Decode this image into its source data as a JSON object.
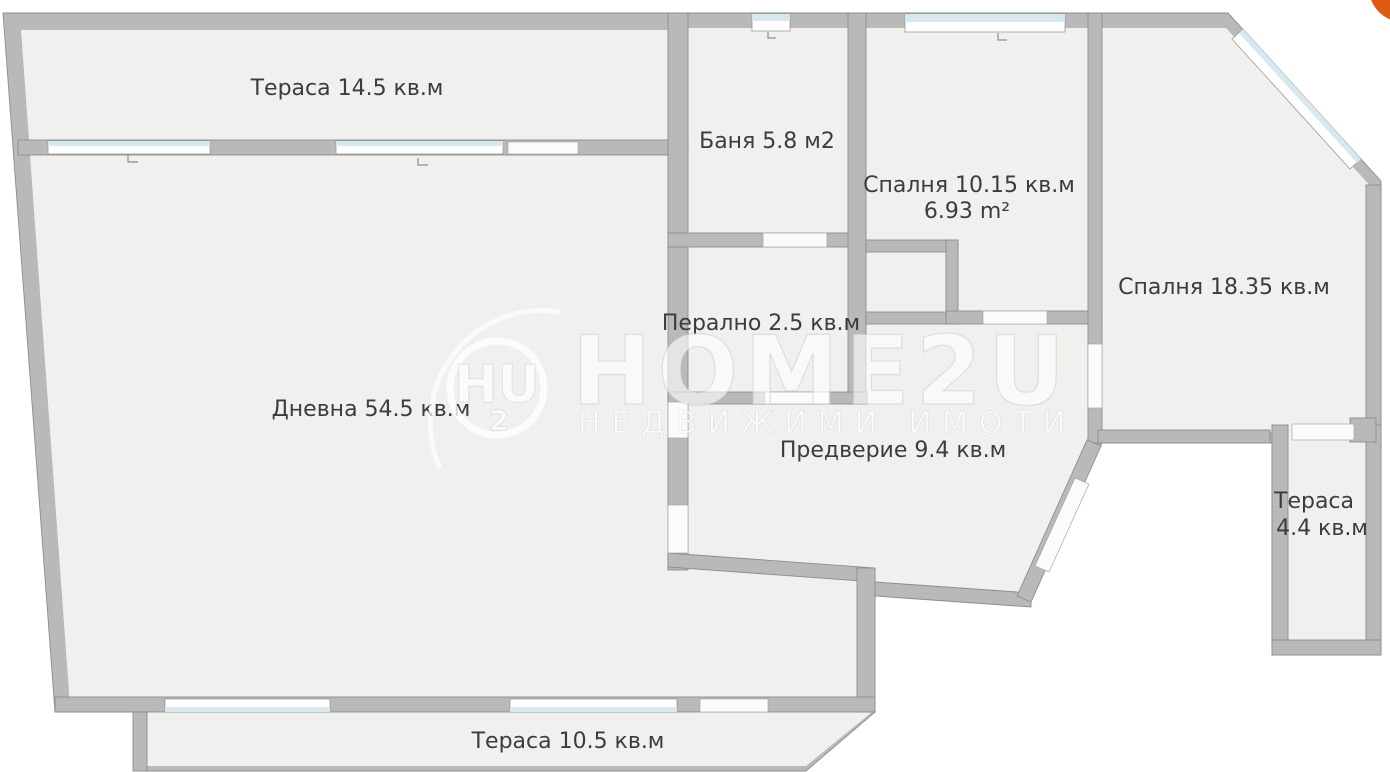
{
  "rooms": [
    {
      "id": "terrace-top",
      "label": "Тераса 14.5 кв.м"
    },
    {
      "id": "bathroom",
      "label": "Баня 5.8 м2"
    },
    {
      "id": "bedroom-small",
      "label": "Спалня 10.15 кв.м",
      "sublabel": "6.93 m²"
    },
    {
      "id": "bedroom-large",
      "label": "Спалня 18.35 кв.м"
    },
    {
      "id": "laundry",
      "label": "Перално 2.5 кв.м"
    },
    {
      "id": "living-room",
      "label": "Дневна 54.5 кв.м"
    },
    {
      "id": "hallway",
      "label": "Предверие 9.4 кв.м"
    },
    {
      "id": "terrace-right",
      "label": "Тераса",
      "sublabel": "4.4 кв.м"
    },
    {
      "id": "terrace-bottom",
      "label": "Тераса 10.5 кв.м"
    }
  ],
  "watermark": {
    "monogram": "HU",
    "monogram_sub": "2",
    "brand": "HOME2U",
    "tagline": "НЕДВИЖИМИ ИМОТИ"
  },
  "colors": {
    "wall": "#b9b9b9",
    "wall_edge": "#8d8d8d",
    "floor": "#f0f0ee",
    "window_glass": "#d7e8f1",
    "label_text": "#3c3c3c",
    "logo_accent": "#dc5a12"
  }
}
